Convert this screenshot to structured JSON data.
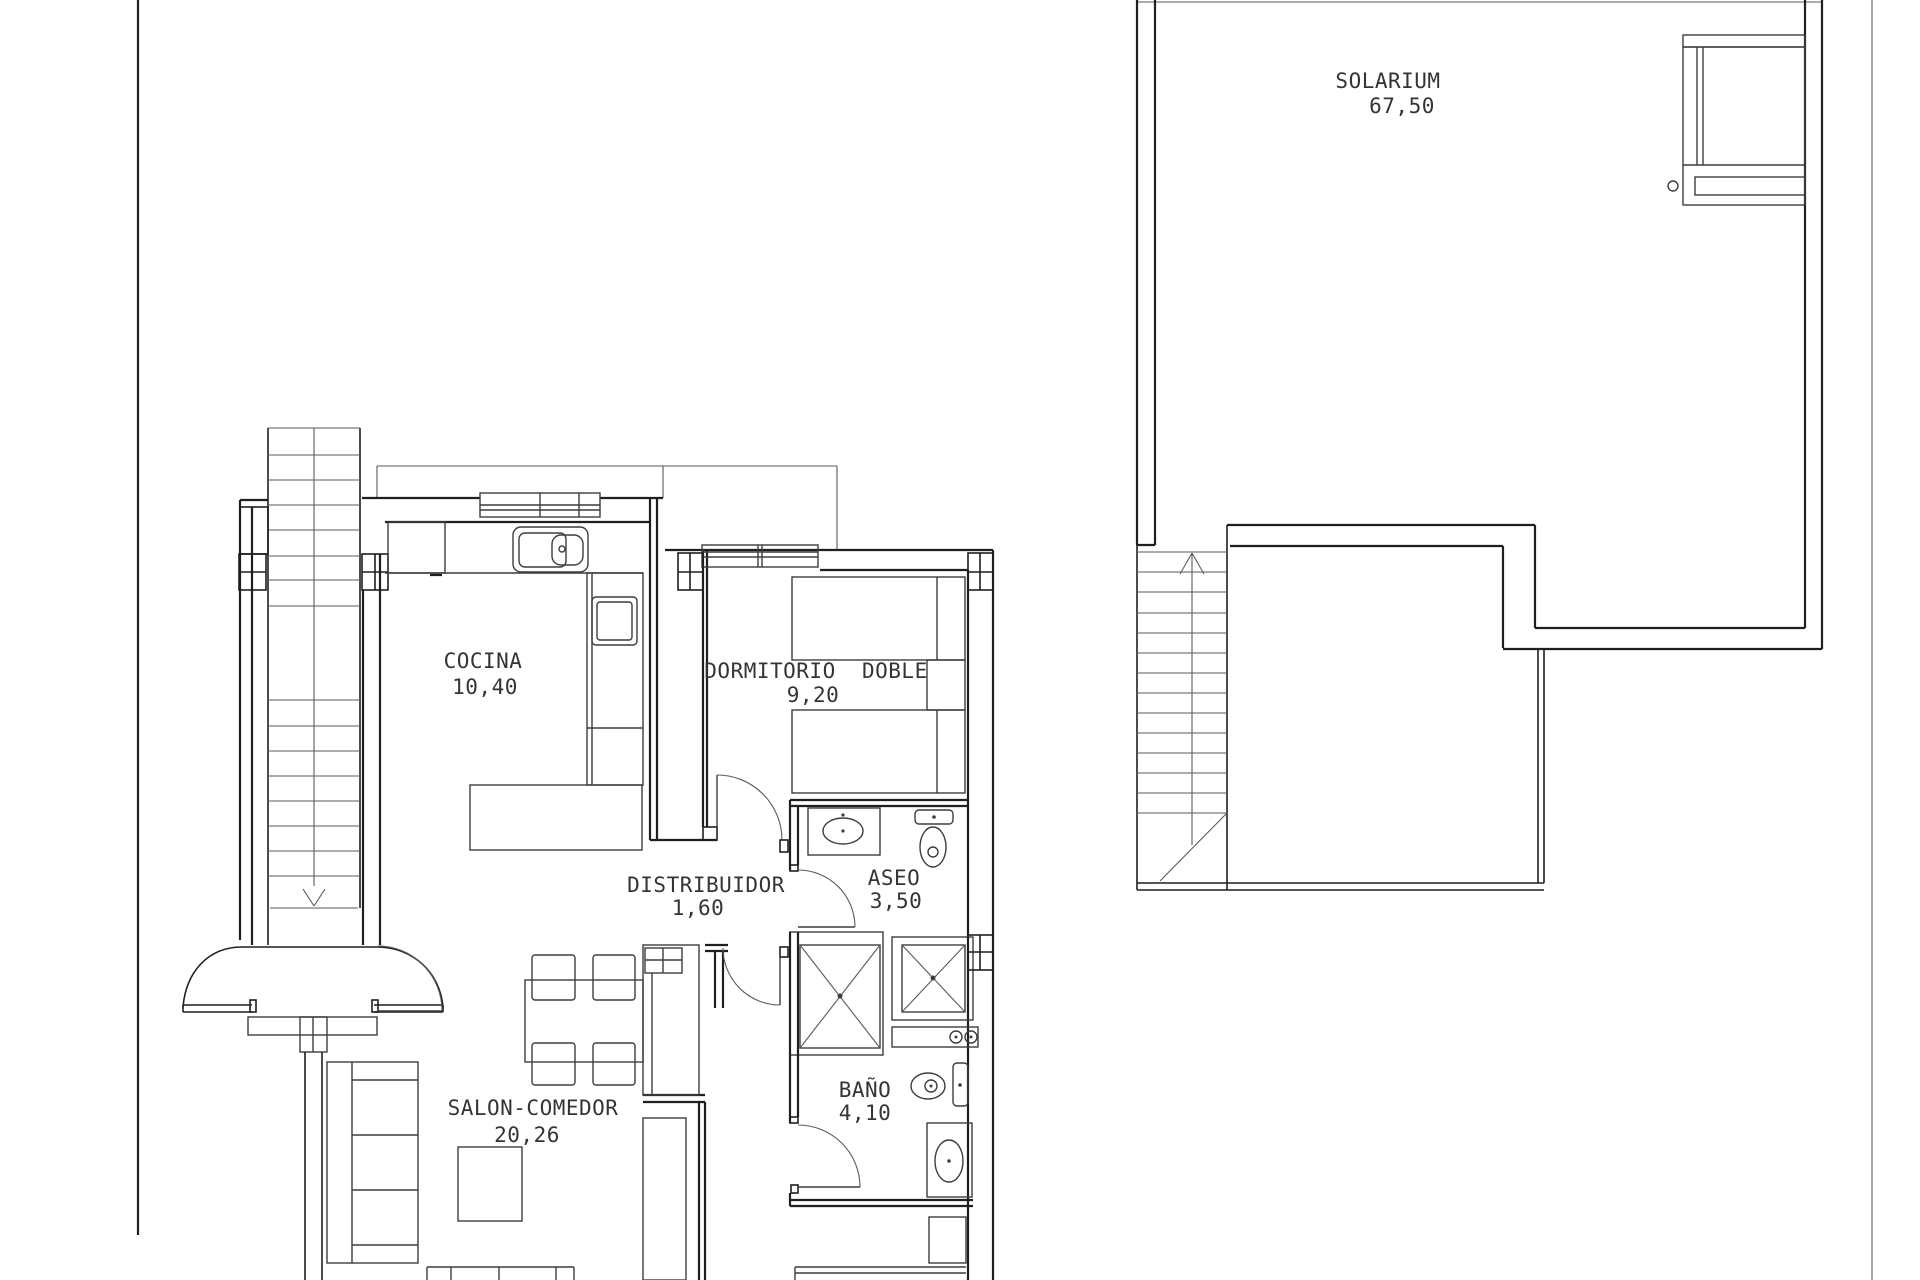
{
  "drawing": {
    "kind": "floor-plan",
    "colors": {
      "background": "#ffffff",
      "wall": "#1f1f1f",
      "furniture": "#3d3d3d",
      "thin": "#5a5a5a",
      "text": "#343434"
    },
    "rooms": {
      "solarium": {
        "name": "SOLARIUM",
        "area": "67,50"
      },
      "cocina": {
        "name": "COCINA",
        "area": "10,40"
      },
      "dormitorio": {
        "name": "DORMITORIO  DOBLE",
        "area": "9,20"
      },
      "distribuidor": {
        "name": "DISTRIBUIDOR",
        "area": "1,60"
      },
      "aseo": {
        "name": "ASEO",
        "area": "3,50"
      },
      "bano": {
        "name": "BAÑO",
        "area": "4,10"
      },
      "salon": {
        "name": "SALON-COMEDOR",
        "area": "20,26"
      }
    }
  }
}
